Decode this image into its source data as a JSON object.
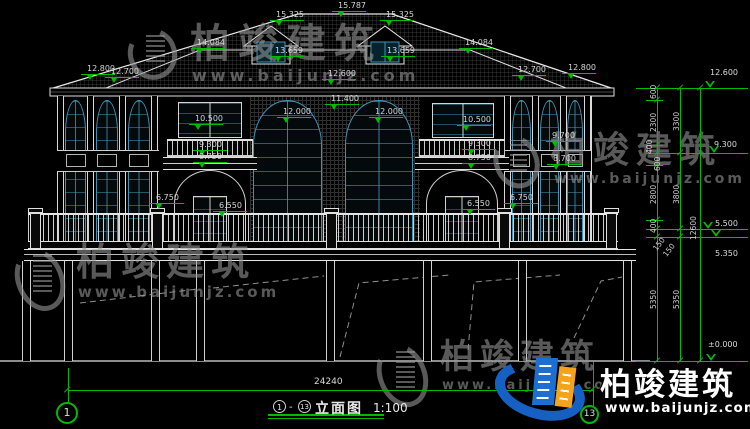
{
  "drawing": {
    "axis_start": "1",
    "axis_end": "13",
    "separator": "-",
    "title": "立面图",
    "scale": "1:100",
    "total_width": "24240",
    "total_height": "12600"
  },
  "watermark": {
    "brand": "柏竣建筑",
    "url": "www.baijunjz.com"
  },
  "logo": {
    "brand": "柏竣建筑",
    "url": "www.baijunjz.com"
  },
  "marks": [
    "15.787",
    "15.325",
    "15.325",
    "13.659",
    "13.659",
    "14.084",
    "14.084",
    "12.800",
    "12.700",
    "12.700",
    "12.800",
    "12.600",
    "11.400",
    "12.000",
    "12.000",
    "10.500",
    "10.500",
    "9.300",
    "9.300",
    "8.750",
    "8.750",
    "9.700",
    "8.700",
    "6.750",
    "6.550",
    "6.550",
    "6.750"
  ],
  "levels": [
    "12.600",
    "9.300",
    "5.500",
    "5.350",
    "±0.000"
  ],
  "vdims": [
    "600",
    "2300",
    "400",
    "600",
    "2800",
    "400",
    "150",
    "150",
    "5350",
    "3300",
    "3800",
    "5350",
    "12600"
  ],
  "hdims": [
    "24240"
  ],
  "colors": {
    "background": "#000000",
    "lines": "#e6e6e6",
    "dimension_green": "#00bb00",
    "window_teal": "#3f93b5",
    "watermark_gray": "#949494",
    "logo_blue": "#1560c2",
    "logo_orange": "#f5a21c"
  }
}
